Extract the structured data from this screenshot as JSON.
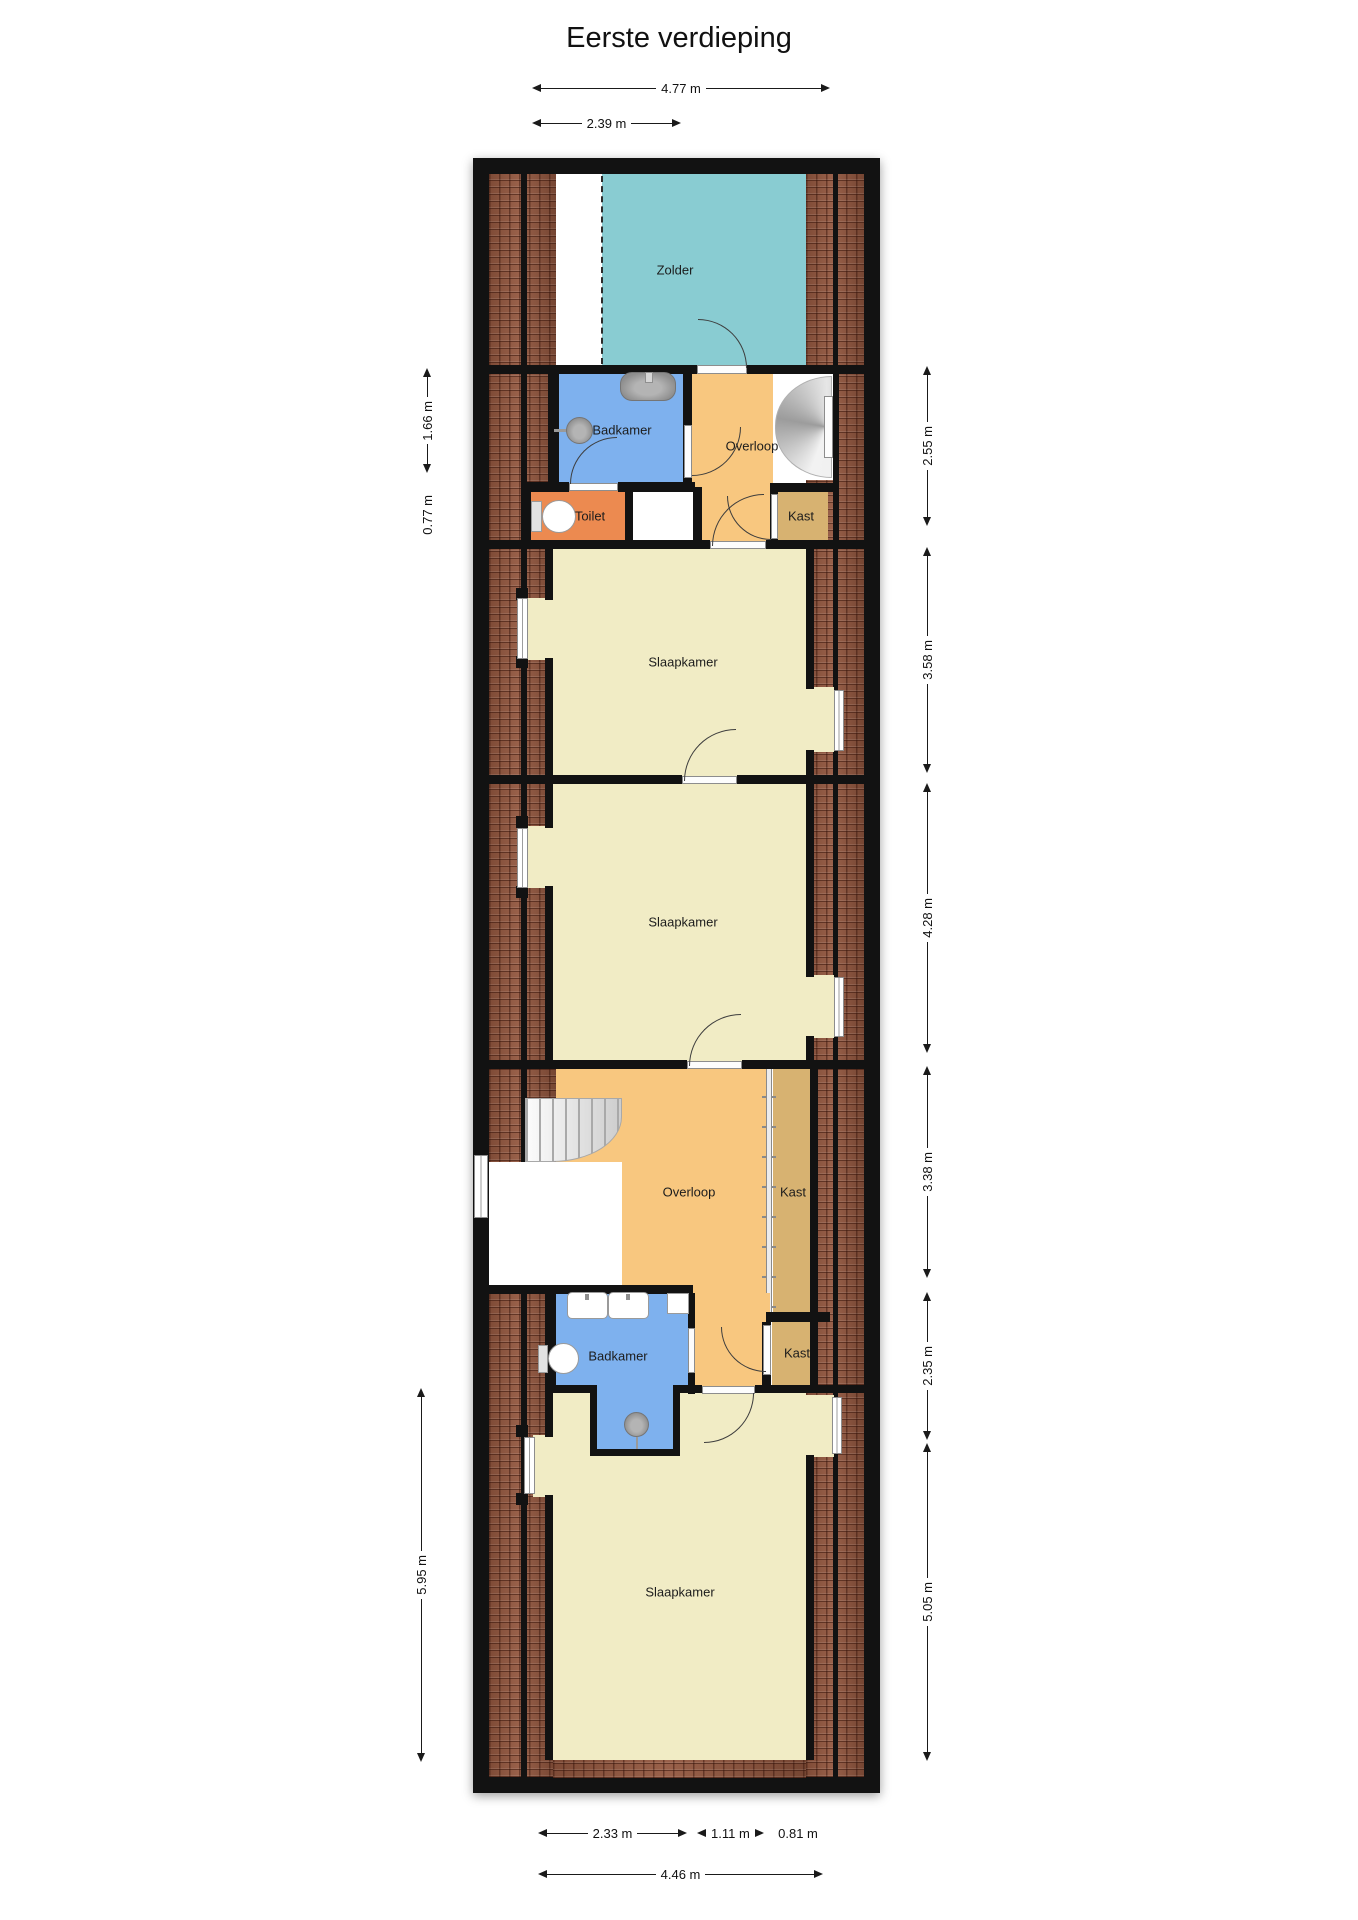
{
  "title": "Eerste verdieping",
  "rooms": {
    "zolder": "Zolder",
    "badkamer1": "Badkamer",
    "overloop1": "Overloop",
    "toilet": "Toilet",
    "kast1": "Kast",
    "slaapkamer1": "Slaapkamer",
    "slaapkamer2": "Slaapkamer",
    "overloop2": "Overloop",
    "kast2": "Kast",
    "badkamer2": "Badkamer",
    "kast3": "Kast",
    "slaapkamer3": "Slaapkamer"
  },
  "dimensions": {
    "top": [
      {
        "label": "4.77 m"
      },
      {
        "label": "2.39 m"
      }
    ],
    "bottom": [
      {
        "label": "2.33 m"
      },
      {
        "label": "1.11 m"
      },
      {
        "label": "0.81 m"
      },
      {
        "label": "4.46 m"
      }
    ],
    "left": [
      {
        "label": "1.66 m"
      },
      {
        "label": "0.77 m"
      },
      {
        "label": "5.95 m"
      }
    ],
    "right": [
      {
        "label": "2.55 m"
      },
      {
        "label": "3.58 m"
      },
      {
        "label": "4.28 m"
      },
      {
        "label": "3.38 m"
      },
      {
        "label": "2.35 m"
      },
      {
        "label": "5.05 m"
      }
    ]
  },
  "fixtures": [
    "sink-icon",
    "shower-head-icon",
    "toilet-icon",
    "staircase-icon",
    "spiral-staircase-icon",
    "folding-door-icon",
    "window-icon",
    "door-swing-icon"
  ],
  "colors": {
    "wall": "#121212",
    "brick": "#93573f",
    "zolder": "#89ccd2",
    "bathroom": "#7eb1ee",
    "hallway": "#f8c77f",
    "toiletroom": "#ec8a50",
    "closet": "#d7b271",
    "bedroom": "#f1ecc5"
  }
}
